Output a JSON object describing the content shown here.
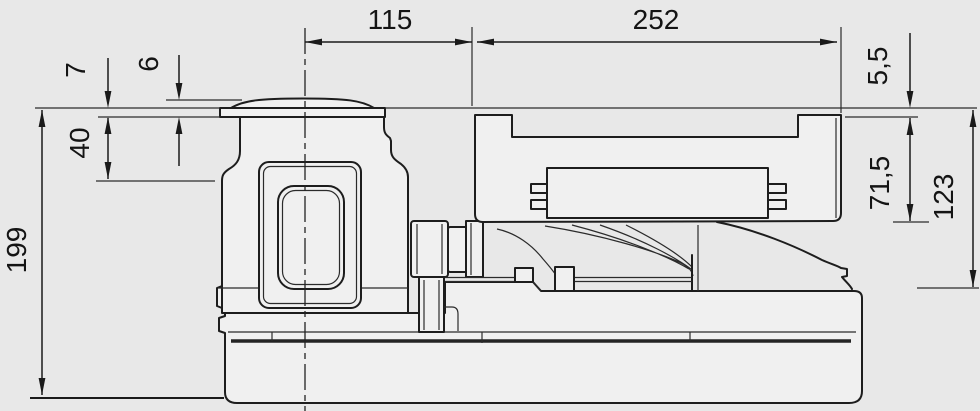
{
  "drawing": {
    "kind_note": "technical dimension drawing, side view",
    "colors": {
      "background": "#e8e8e8",
      "line": "#1d1d1d",
      "part_fill": "#f0f0f0"
    },
    "dims": {
      "d115": "115",
      "d252": "252",
      "d7": "7",
      "d6": "6",
      "d40": "40",
      "d199": "199",
      "d5_5": "5,5",
      "d71_5": "71,5",
      "d123": "123"
    }
  }
}
